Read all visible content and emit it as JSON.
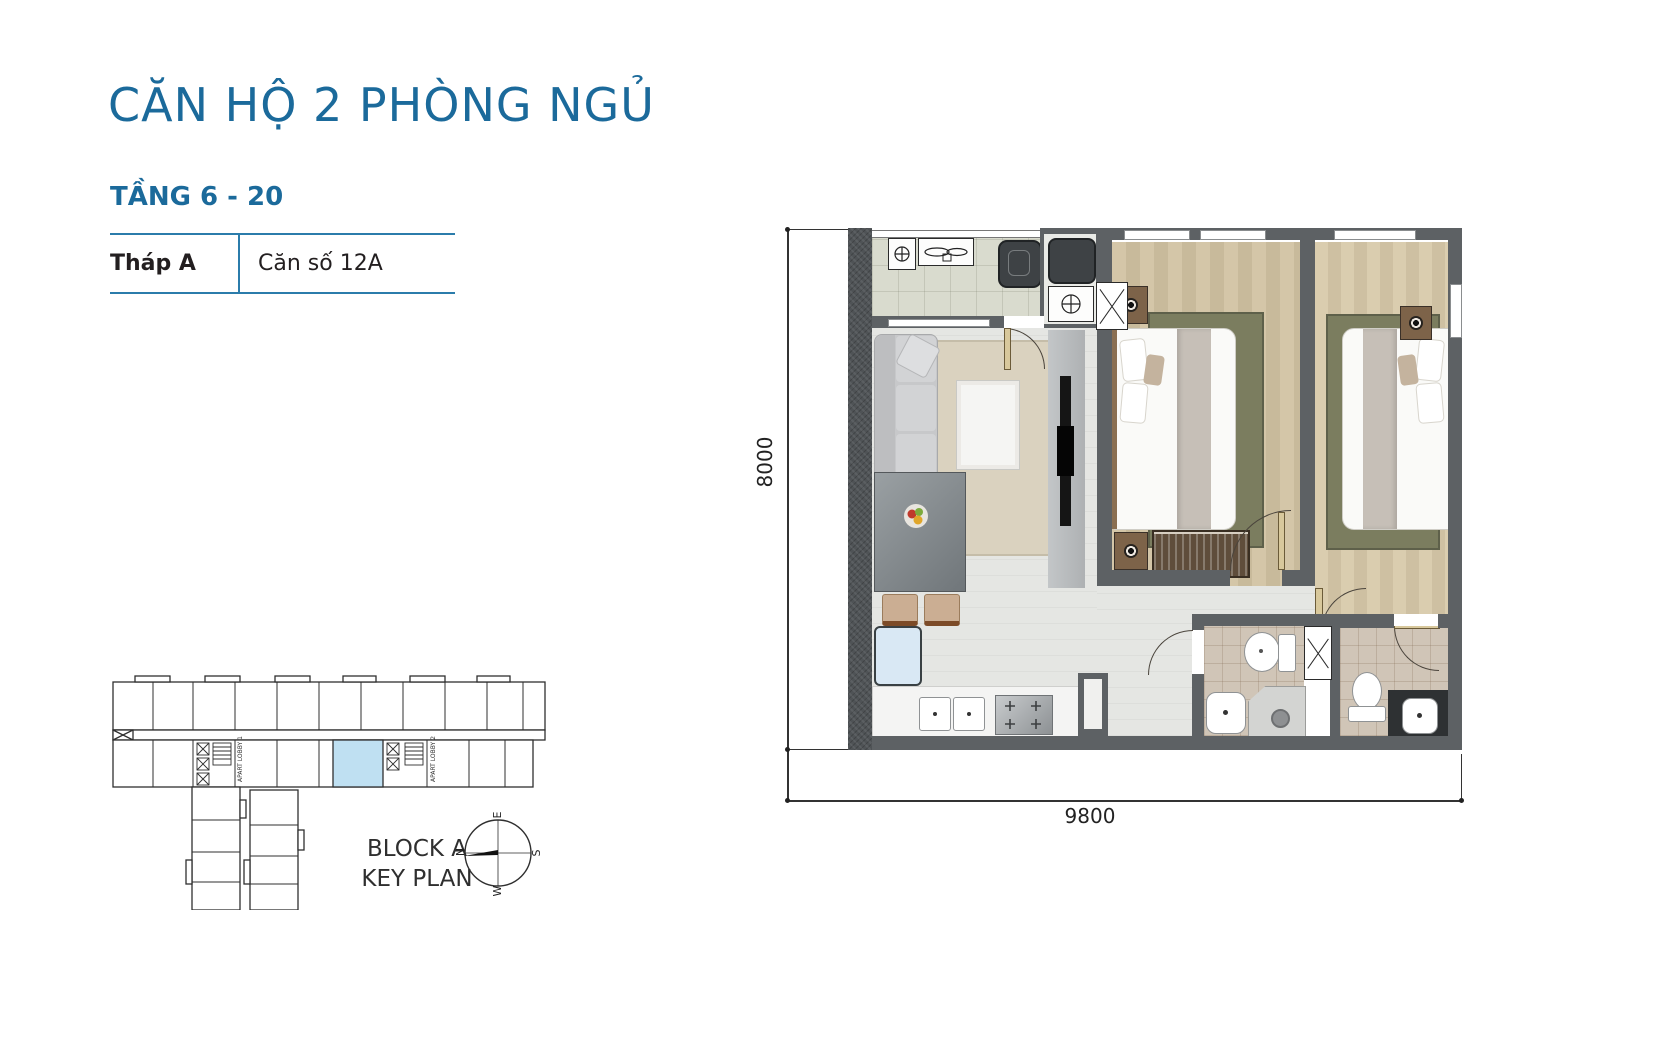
{
  "header": {
    "title": "CĂN HỘ 2 PHÒNG NGỦ",
    "floor_range": "TẦNG 6 - 20",
    "tower_label": "Tháp A",
    "unit_label": "Căn số 12A"
  },
  "floor_plan": {
    "dimension_height": "8000",
    "dimension_width": "9800"
  },
  "key_plan": {
    "block_label": "BLOCK A",
    "plan_label": "KEY PLAN",
    "lobby_1": "APART LOBBY 1",
    "lobby_2": "APART LOBBY 2"
  },
  "compass": {
    "n": "N",
    "e": "E",
    "s": "S",
    "w": "W"
  },
  "colors": {
    "accent_blue": "#1b6a9b",
    "table_border_blue": "#2b7cab",
    "highlight_unit": "#bfe0f2",
    "wall_gray": "#5d6164",
    "wood_floor": "#cfc1a2",
    "rug_green": "#7b7d5f",
    "living_tile": "#e5e6e3",
    "balcony_tile": "#d9dbce",
    "bath_tile": "#d0c5b7"
  }
}
